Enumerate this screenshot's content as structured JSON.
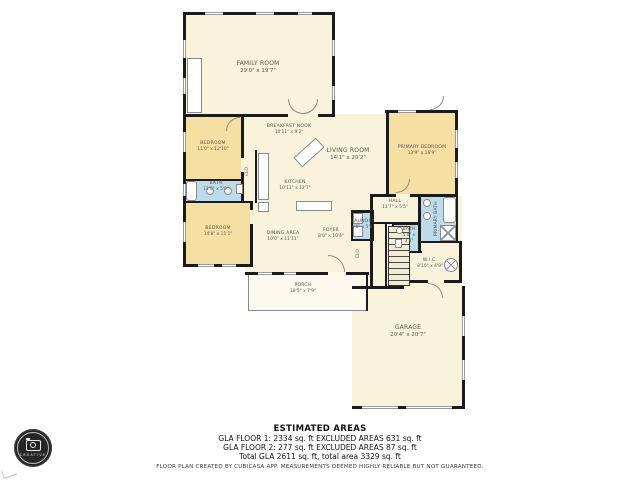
{
  "rooms": {
    "family": {
      "name": "FAMILY ROOM",
      "dims": "29'0\" x 19'7\""
    },
    "breakfast": {
      "name": "BREAKFAST NOOK",
      "dims": "10'11\" x 9'2\""
    },
    "bedroom1": {
      "name": "BEDROOM",
      "dims": "11'0\" x 12'10\""
    },
    "bath1": {
      "name": "BATH",
      "dims": "11'0\" x 5'0\""
    },
    "bedroom2": {
      "name": "BEDROOM",
      "dims": "14'8\" x 11'1\""
    },
    "kitchen": {
      "name": "KITCHEN",
      "dims": "10'11\" x 12'7\""
    },
    "living": {
      "name": "LIVING ROOM",
      "dims": "14'1\" x 20'2\""
    },
    "primary_bedroom": {
      "name": "PRIMARY BEDROOM",
      "dims": "13'9\" x 16'9\""
    },
    "dining": {
      "name": "DINING AREA",
      "dims": "10'0\" x 11'11\""
    },
    "foyer": {
      "name": "FOYER",
      "dims": "8'0\" x 10'4\""
    },
    "laundry": {
      "name": "LAUNDRY",
      "dims": "4'0\" x 5'8\""
    },
    "hall": {
      "name": "HALL",
      "dims": "11'7\" x 5'5\""
    },
    "primary_bath": {
      "name": "PRIMARY BATH",
      "dims": "7'4\" x 8'9\""
    },
    "bath2": {
      "name": "BATH",
      "dims": "5'0\" x 3'8\""
    },
    "wic": {
      "name": "W.I.C.",
      "dims": "8'10\" x 4'9\""
    },
    "porch": {
      "name": "PORCH",
      "dims": "18'5\" x 7'9\""
    },
    "garage": {
      "name": "GARAGE",
      "dims": "20'4\" x 20'7\""
    }
  },
  "closets": {
    "clo1": "CLO.",
    "clo2": "CLO."
  },
  "footer": {
    "title": "ESTIMATED AREAS",
    "line1": "GLA FLOOR 1: 2334 sq. ft EXCLUDED AREAS 631 sq. ft",
    "line2": "GLA FLOOR 2: 277 sq. ft EXCLUDED AREAS 87 sq. ft",
    "line3": "Total GLA 2611 sq. ft, total area 3329 sq. ft",
    "disclaimer": "FLOOR PLAN CREATED BY CUBICASA APP. MEASUREMENTS DEEMED HIGHLY RELIABLE BUT NOT GUARANTEED."
  },
  "logo": {
    "text": "CREATIVE"
  },
  "colors": {
    "wall": "#1b1b1b",
    "floor": "#faf3dc",
    "bedroom": "#f6dfa2",
    "bath": "#bcdcec",
    "porch": "#fdf9ec"
  }
}
